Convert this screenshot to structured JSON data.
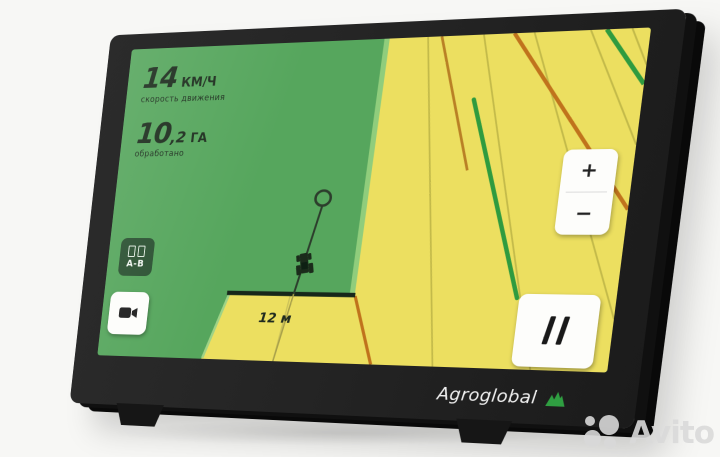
{
  "device": {
    "brand": "Agroglobal",
    "screen": {
      "telemetry": {
        "speed_value": "14",
        "speed_unit": "КМ/Ч",
        "speed_label": "скорость движения",
        "area_value": "10",
        "area_decimal": ",2",
        "area_unit": "ГА",
        "area_label": "обработано"
      },
      "map": {
        "distance_label": "12 м",
        "field_processed_color": "#56a65d",
        "field_unprocessed_color": "#ecdf60",
        "boundary_highlight_color": "#90cd7c",
        "guidance_green_color": "#2f9b3f",
        "guidance_orange_color": "#c0731c",
        "ab_baseline_color": "#17271a"
      },
      "buttons": {
        "ab_label": "A-B",
        "zoom_in_label": "+",
        "zoom_out_label": "−"
      }
    }
  },
  "watermark": {
    "text": "Avito"
  }
}
